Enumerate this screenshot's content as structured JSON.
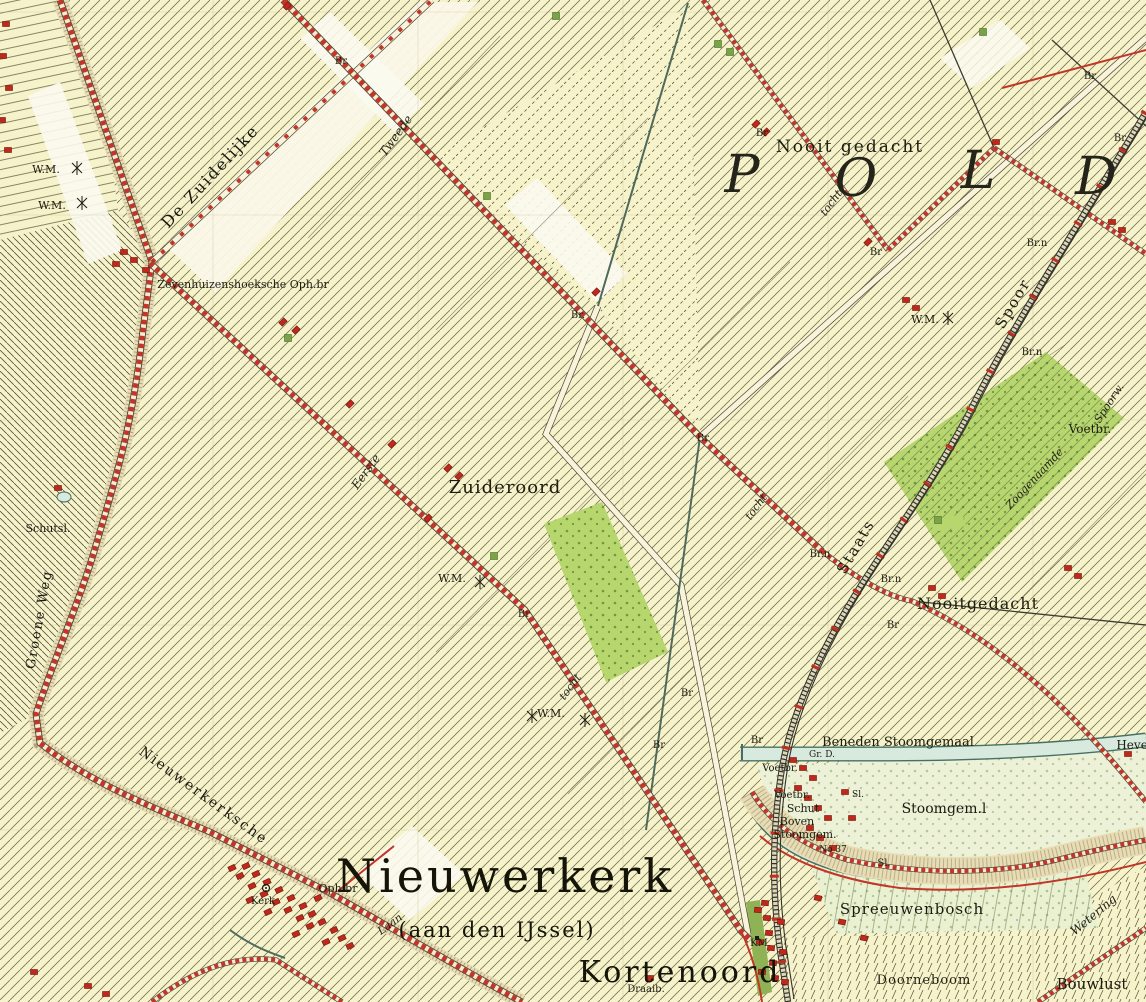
{
  "map": {
    "region": "Nieuwerkerk (aan den IJssel)",
    "kind": "historical chromo-topographic polder map"
  },
  "colors": {
    "paper": "#f6f3cb",
    "hatch": "#56553c",
    "road_red": "#c23527",
    "water_fill": "#d8e9dd",
    "water_edge": "#477064",
    "orchard_green": "#b7d66e",
    "building_red": "#c0281c",
    "railway": "#33322a"
  },
  "labels": [
    {
      "t": "P",
      "x": 742,
      "y": 192,
      "s": 52,
      "c": "big"
    },
    {
      "t": "O",
      "x": 856,
      "y": 196,
      "s": 52,
      "c": "big"
    },
    {
      "t": "L",
      "x": 978,
      "y": 188,
      "s": 52,
      "c": "big"
    },
    {
      "t": "D",
      "x": 1096,
      "y": 194,
      "s": 52,
      "c": "big"
    },
    {
      "t": "Nooit gedacht",
      "x": 850,
      "y": 152,
      "s": 17,
      "c": "place",
      "ls": 2
    },
    {
      "t": "Zuideroord",
      "x": 505,
      "y": 493,
      "s": 18,
      "c": "place",
      "ls": 1
    },
    {
      "t": "Nooitgedacht",
      "x": 978,
      "y": 609,
      "s": 16,
      "c": "place",
      "ls": 1
    },
    {
      "t": "Nieuwerkerk",
      "x": 505,
      "y": 892,
      "s": 46,
      "c": "town"
    },
    {
      "t": "(aan den IJssel)",
      "x": 497,
      "y": 937,
      "s": 21,
      "c": "town2"
    },
    {
      "t": "Kortenoord",
      "x": 680,
      "y": 982,
      "s": 30,
      "c": "town"
    },
    {
      "t": "Spreeuwenbosch",
      "x": 912,
      "y": 914,
      "s": 15,
      "c": "place",
      "ls": 1
    },
    {
      "t": "Doorneboom",
      "x": 924,
      "y": 984,
      "s": 13,
      "c": "place",
      "ls": 1
    },
    {
      "t": "Bouwlust",
      "x": 1092,
      "y": 989,
      "s": 15,
      "c": "place"
    },
    {
      "t": "Beneden Stoomgemaal",
      "x": 898,
      "y": 746,
      "s": 13,
      "c": "place"
    },
    {
      "t": "Stoomgem.l",
      "x": 944,
      "y": 813,
      "s": 14,
      "c": "place"
    },
    {
      "t": "Boven",
      "x": 797,
      "y": 825,
      "s": 11,
      "c": "place"
    },
    {
      "t": "Stoomgem.",
      "x": 805,
      "y": 838,
      "s": 11,
      "c": "place"
    },
    {
      "t": "Schut",
      "x": 803,
      "y": 812,
      "s": 11,
      "c": "place"
    },
    {
      "t": "Voetbr.",
      "x": 780,
      "y": 771,
      "s": 10,
      "c": "place"
    },
    {
      "t": "Voetbr.",
      "x": 792,
      "y": 798,
      "s": 10,
      "c": "place"
    },
    {
      "t": "Voetbr.",
      "x": 1090,
      "y": 433,
      "s": 12,
      "c": "place"
    },
    {
      "t": "Sl.",
      "x": 858,
      "y": 797,
      "s": 9,
      "c": "place"
    },
    {
      "t": "Sl.",
      "x": 884,
      "y": 866,
      "s": 10,
      "c": "place"
    },
    {
      "t": "No 37",
      "x": 833,
      "y": 852,
      "s": 9,
      "c": "place"
    },
    {
      "t": "Gr. D.",
      "x": 822,
      "y": 757,
      "s": 9,
      "c": "place"
    },
    {
      "t": "Hevel",
      "x": 1134,
      "y": 749,
      "s": 12,
      "c": "place"
    },
    {
      "t": "KM",
      "x": 759,
      "y": 946,
      "s": 10,
      "c": "place"
    },
    {
      "t": "Draaib.",
      "x": 646,
      "y": 992,
      "s": 10,
      "c": "place"
    },
    {
      "t": "Oph.br",
      "x": 338,
      "y": 892,
      "s": 11,
      "c": "place"
    },
    {
      "t": "Kerk",
      "x": 263,
      "y": 904,
      "s": 10,
      "c": "place"
    },
    {
      "t": "Schutsl.",
      "x": 48,
      "y": 532,
      "s": 11,
      "c": "place"
    },
    {
      "t": "Zevenhuizenshoeksche Oph.br",
      "x": 243,
      "y": 288,
      "s": 11,
      "c": "place"
    },
    {
      "t": "W.M.",
      "x": 46,
      "y": 173,
      "s": 11,
      "c": "place"
    },
    {
      "t": "W.M.",
      "x": 52,
      "y": 209,
      "s": 11,
      "c": "place"
    },
    {
      "t": "W.M.",
      "x": 925,
      "y": 323,
      "s": 11,
      "c": "place"
    },
    {
      "t": "W.M.",
      "x": 452,
      "y": 582,
      "s": 11,
      "c": "place"
    },
    {
      "t": "W.M.",
      "x": 551,
      "y": 717,
      "s": 11,
      "c": "place"
    },
    {
      "t": "Br.",
      "x": 342,
      "y": 64,
      "s": 10,
      "c": "place"
    },
    {
      "t": "Br",
      "x": 762,
      "y": 136,
      "s": 10,
      "c": "place"
    },
    {
      "t": "Br",
      "x": 876,
      "y": 255,
      "s": 10,
      "c": "place"
    },
    {
      "t": "Br.",
      "x": 578,
      "y": 318,
      "s": 10,
      "c": "place"
    },
    {
      "t": "Br",
      "x": 703,
      "y": 441,
      "s": 10,
      "c": "place"
    },
    {
      "t": "Br",
      "x": 1090,
      "y": 79,
      "s": 10,
      "c": "place"
    },
    {
      "t": "Br",
      "x": 1120,
      "y": 141,
      "s": 10,
      "c": "place"
    },
    {
      "t": "Br.n",
      "x": 1037,
      "y": 246,
      "s": 10,
      "c": "place"
    },
    {
      "t": "Br.n",
      "x": 1032,
      "y": 355,
      "s": 10,
      "c": "place"
    },
    {
      "t": "Br.n",
      "x": 820,
      "y": 557,
      "s": 10,
      "c": "place"
    },
    {
      "t": "Br.n",
      "x": 891,
      "y": 582,
      "s": 10,
      "c": "place"
    },
    {
      "t": "Br",
      "x": 893,
      "y": 628,
      "s": 10,
      "c": "place"
    },
    {
      "t": "Br",
      "x": 524,
      "y": 617,
      "s": 10,
      "c": "place"
    },
    {
      "t": "Br",
      "x": 659,
      "y": 748,
      "s": 10,
      "c": "place"
    },
    {
      "t": "Br",
      "x": 687,
      "y": 696,
      "s": 10,
      "c": "place"
    },
    {
      "t": "Br",
      "x": 757,
      "y": 743,
      "s": 10,
      "c": "place"
    },
    {
      "t": "De Zuidelijke",
      "x": 214,
      "y": 180,
      "s": 16,
      "c": "road",
      "r": -47
    },
    {
      "t": "Nieuwerkerksche",
      "x": 201,
      "y": 799,
      "s": 14,
      "c": "road",
      "r": 36,
      "ls": 2
    },
    {
      "t": "Groene Weg",
      "x": 43,
      "y": 620,
      "s": 13,
      "c": "road",
      "r": -80,
      "ls": 2
    },
    {
      "t": "Tweede",
      "x": 399,
      "y": 138,
      "s": 12,
      "c": "script",
      "r": -54
    },
    {
      "t": "Eerste",
      "x": 369,
      "y": 474,
      "s": 12,
      "c": "script",
      "r": -54
    },
    {
      "t": "tocht",
      "x": 834,
      "y": 205,
      "s": 11,
      "c": "script",
      "r": -54
    },
    {
      "t": "tocht",
      "x": 759,
      "y": 509,
      "s": 11,
      "c": "script",
      "r": -54
    },
    {
      "t": "tocht",
      "x": 573,
      "y": 689,
      "s": 11,
      "c": "script",
      "r": -54
    },
    {
      "t": "Staats",
      "x": 860,
      "y": 549,
      "s": 15,
      "c": "place",
      "r": -60,
      "ls": 2
    },
    {
      "t": "Spoor",
      "x": 1017,
      "y": 306,
      "s": 15,
      "c": "place",
      "r": -60,
      "ls": 2
    },
    {
      "t": "Spoorw.",
      "x": 1112,
      "y": 405,
      "s": 11,
      "c": "script",
      "r": -57
    },
    {
      "t": "Zoogenaamde",
      "x": 1037,
      "y": 481,
      "s": 11,
      "c": "script",
      "r": -47
    },
    {
      "t": "Wetering",
      "x": 1096,
      "y": 918,
      "s": 12,
      "c": "script",
      "r": -40
    },
    {
      "t": "Laan",
      "x": 392,
      "y": 927,
      "s": 11,
      "c": "script",
      "r": -36
    }
  ],
  "buildings": [
    [
      246,
      866,
      -25
    ],
    [
      256,
      874,
      -25
    ],
    [
      267,
      882,
      -25
    ],
    [
      279,
      890,
      -25
    ],
    [
      291,
      898,
      -25
    ],
    [
      303,
      906,
      -25
    ],
    [
      252,
      886,
      -25
    ],
    [
      264,
      894,
      -25
    ],
    [
      276,
      902,
      -25
    ],
    [
      288,
      910,
      -25
    ],
    [
      300,
      918,
      -25
    ],
    [
      312,
      914,
      -25
    ],
    [
      322,
      922,
      -25
    ],
    [
      334,
      930,
      -25
    ],
    [
      318,
      898,
      -25
    ],
    [
      240,
      876,
      -25
    ],
    [
      310,
      926,
      -25
    ],
    [
      296,
      934,
      -25
    ],
    [
      268,
      912,
      -25
    ],
    [
      342,
      938,
      -25
    ],
    [
      232,
      868,
      -25
    ],
    [
      250,
      900,
      -25
    ],
    [
      326,
      942,
      -25
    ],
    [
      350,
      946,
      -25
    ],
    [
      765,
      903,
      5
    ],
    [
      767,
      918,
      5
    ],
    [
      769,
      933,
      5
    ],
    [
      771,
      948,
      5
    ],
    [
      773,
      963,
      5
    ],
    [
      775,
      978,
      5
    ],
    [
      758,
      910,
      5
    ],
    [
      760,
      942,
      5
    ],
    [
      762,
      972,
      5
    ],
    [
      781,
      922,
      5
    ],
    [
      783,
      952,
      5
    ],
    [
      785,
      982,
      5
    ],
    [
      793,
      760,
      0
    ],
    [
      803,
      768,
      0
    ],
    [
      813,
      778,
      0
    ],
    [
      798,
      788,
      0
    ],
    [
      808,
      798,
      0
    ],
    [
      818,
      808,
      0
    ],
    [
      828,
      818,
      0
    ],
    [
      810,
      828,
      0
    ],
    [
      820,
      838,
      0
    ],
    [
      833,
      848,
      0
    ],
    [
      845,
      792,
      0
    ],
    [
      852,
      818,
      0
    ],
    [
      818,
      898,
      12
    ],
    [
      842,
      922,
      12
    ],
    [
      864,
      938,
      12
    ],
    [
      448,
      468,
      -45
    ],
    [
      459,
      476,
      -45
    ],
    [
      283,
      322,
      -45
    ],
    [
      296,
      330,
      -45
    ],
    [
      906,
      300,
      0
    ],
    [
      916,
      308,
      0
    ],
    [
      932,
      588,
      0
    ],
    [
      942,
      596,
      0
    ],
    [
      1068,
      568,
      0
    ],
    [
      1078,
      576,
      0
    ],
    [
      1112,
      222,
      0
    ],
    [
      1122,
      230,
      0
    ],
    [
      124,
      252,
      0
    ],
    [
      134,
      260,
      0
    ],
    [
      116,
      264,
      0
    ],
    [
      146,
      270,
      0
    ],
    [
      6,
      24,
      0
    ],
    [
      3,
      56,
      0
    ],
    [
      9,
      88,
      0
    ],
    [
      2,
      120,
      0
    ],
    [
      8,
      150,
      0
    ],
    [
      34,
      972,
      0
    ],
    [
      88,
      986,
      0
    ],
    [
      106,
      994,
      0
    ],
    [
      596,
      292,
      -45
    ],
    [
      868,
      242,
      -45
    ],
    [
      287,
      6,
      -45
    ],
    [
      350,
      404,
      -45
    ],
    [
      392,
      444,
      -45
    ],
    [
      428,
      518,
      -45
    ],
    [
      996,
      142,
      0
    ],
    [
      756,
      124,
      -45
    ],
    [
      766,
      132,
      -45
    ],
    [
      58,
      488,
      0
    ],
    [
      650,
      978,
      0
    ],
    [
      1128,
      754,
      0
    ]
  ],
  "trees": [
    [
      487,
      196
    ],
    [
      718,
      44
    ],
    [
      983,
      32
    ],
    [
      288,
      338
    ],
    [
      494,
      556
    ],
    [
      938,
      520
    ],
    [
      556,
      16
    ],
    [
      730,
      52
    ]
  ],
  "symbols": {
    "windmills": [
      [
        77,
        168
      ],
      [
        82,
        203
      ],
      [
        948,
        318
      ],
      [
        480,
        582
      ],
      [
        532,
        716
      ],
      [
        585,
        720
      ]
    ],
    "church": [
      266,
      888
    ],
    "km_post": [
      757,
      938
    ]
  }
}
